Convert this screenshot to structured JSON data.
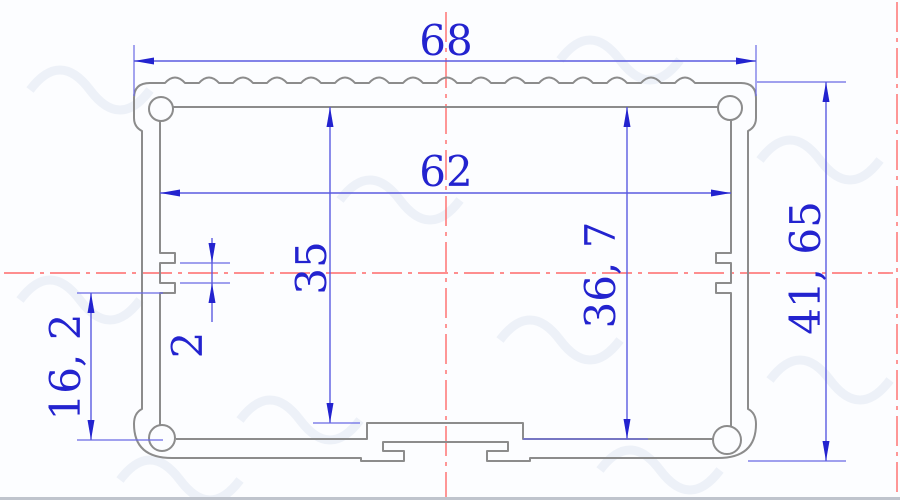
{
  "drawing": {
    "dims": {
      "outer_width": "68",
      "inner_width": "62",
      "cavity_height_left": "35",
      "cavity_height_right": "36, 7",
      "lower_section_height": "16, 2",
      "slot_width": "2",
      "overall_height": "41, 65"
    },
    "colors": {
      "dimension_text": "#2323cf",
      "dimension_line": "#5b5be0",
      "centerline": "#ff6a6a",
      "profile_outline": "#8c8c8c",
      "background": "#fcfdff"
    }
  }
}
